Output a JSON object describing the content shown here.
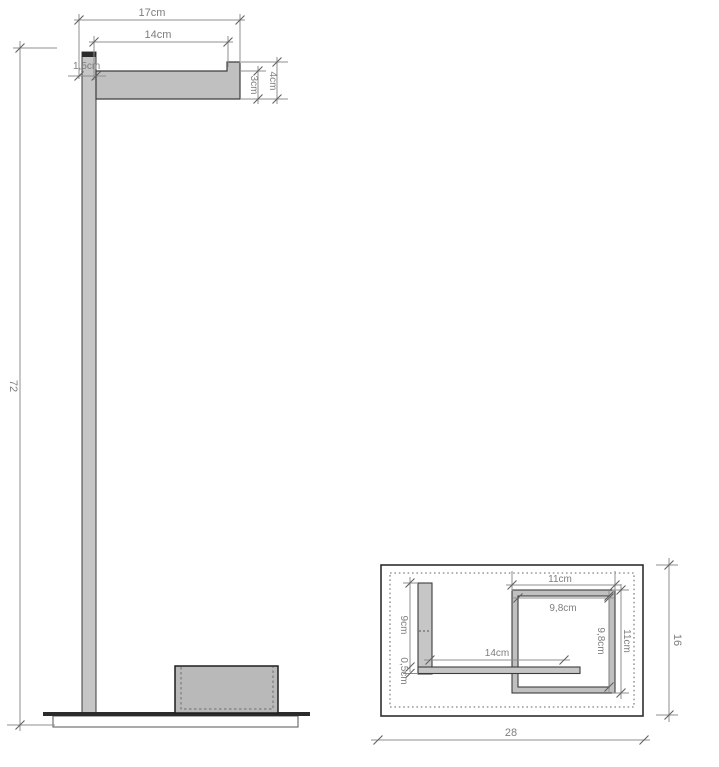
{
  "drawing": {
    "title": "stand dimension drawing",
    "front_view": {
      "dim_height_total": "72",
      "dim_arm_outer": "17cm",
      "dim_arm_inner": "14cm",
      "dim_pole_width": "1,5cm",
      "dim_arm_thickness": "3cm",
      "dim_arm_end_height": "4cm"
    },
    "top_view": {
      "dim_frame_outer_width": "11cm",
      "dim_frame_inner_width": "9,8cm",
      "dim_frame_inner_height": "9,8cm",
      "dim_frame_outer_height": "11cm",
      "dim_pole_depth": "9cm",
      "dim_bar_thickness": "0,5cm",
      "dim_arm_length": "14cm",
      "dim_base_depth": "16",
      "dim_base_width": "28"
    },
    "colors": {
      "object_line": "#2f2f2f",
      "metal_fill": "#c4c4c4",
      "box_fill": "#b9b9b9",
      "dim_line": "#8f8f8f",
      "dim_text": "#7e7e7e",
      "background": "#ffffff"
    }
  }
}
